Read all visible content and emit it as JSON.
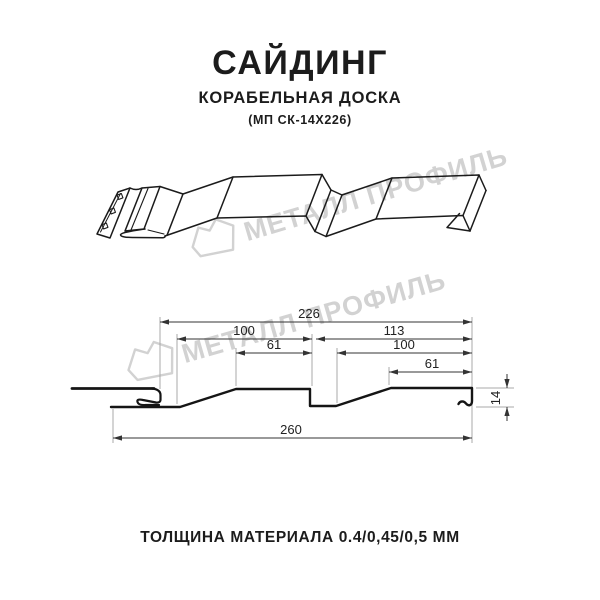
{
  "header": {
    "title": "САЙДИНГ",
    "subtitle": "КОРАБЕЛЬНАЯ ДОСКА",
    "code": "(МП СК-14Х226)"
  },
  "watermark": {
    "brand": "МЕТАЛЛ ПРОФИЛЬ"
  },
  "drawing": {
    "dimensions": {
      "top_width": "226",
      "left_section_width": "100",
      "left_top_flat": "61",
      "right_section_width": "113",
      "right_inner_width": "100",
      "right_top_flat": "61",
      "profile_height": "14",
      "overall_width": "260"
    }
  },
  "footer": {
    "caption": "ТОЛЩИНА МАТЕРИАЛА 0.4/0,45/0,5 ММ"
  },
  "colors": {
    "background": "#ffffff",
    "line": "#1b1b1b",
    "dimension": "#333333",
    "extension": "#a8a8a8",
    "watermark": "#d2d2d2",
    "text": "#1c1c1c"
  }
}
